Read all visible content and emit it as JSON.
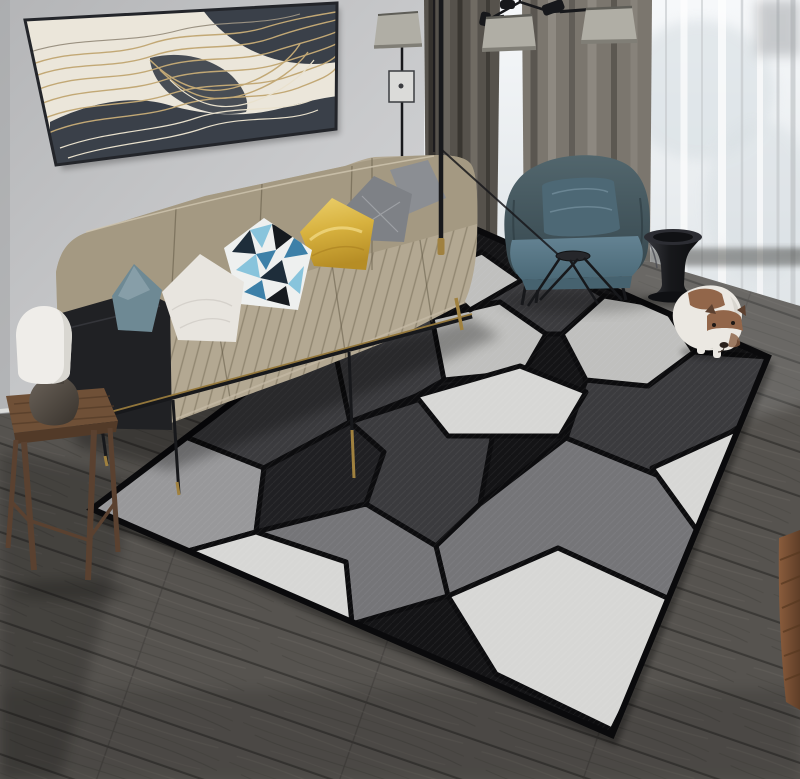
{
  "meta": {
    "type": "photograph",
    "description": "Modern living room with a beige fabric sofa, colorful pillows, abstract gold-line wall art, a teal armchair, black floor and ceiling lamps, sheer curtains over a bright snowy window, dark wood plank flooring, a black pedestal side table, a white-and-brown puppy, and a large gray 3D geometric polygon area rug.",
    "width": 800,
    "height": 779
  },
  "palette": {
    "wall": "#c9cacc",
    "wallDeep": "#b2b3b5",
    "baseboard": "#dcdddb",
    "artBg": "#ebe6da",
    "artDark": "#3a4049",
    "artGold": "#c2a875",
    "artFrame": "#23252a",
    "curtainDark": "#56524c",
    "curtainMid": "#7b766e",
    "curtainLight": "#918c84",
    "sheer": "#e9ebed",
    "window": "#f4f6f8",
    "snowShade": "#d5dde1",
    "sheerFold": "#ffffff",
    "sheerGray": "#c6cacd",
    "lampShade": "#b0aea5",
    "lampShadeDark": "#807e76",
    "metal": "#17181b",
    "brass": "#a0813f",
    "floor": "#56534f",
    "plankGap": "#3b3936",
    "grainDark": "#45423e",
    "grainLight": "#696560",
    "rugBase": "#141416",
    "rugGap": "#0c0c0e",
    "rugWhite": "#d7d7d5",
    "rugLight": "#c0c0be",
    "rugMidLight": "#98989a",
    "rugMid": "#757578",
    "rugDark": "#3b3b3e",
    "rugBlack": "#202023",
    "sofa": "#b3a892",
    "sofaDark": "#a1967f",
    "sofaBase": "#202124",
    "pTeal": "#6e8994",
    "pWhite": "#e8e5df",
    "pGold": "#d7b13e",
    "pGray1": "#7e8186",
    "pGray2": "#8b8e93",
    "geoLight": "#88c4dc",
    "geoBlue": "#3d80a8",
    "geoNavy": "#1e2d3a",
    "geoBlack": "#161a1e",
    "geoWhite": "#eef0ef",
    "chair": "#46585e",
    "chairSeat": "#587586",
    "chairPillow": "#4d6875",
    "stool": "#1c1d20",
    "wood": "#6f5037",
    "woodDark": "#523a28",
    "dogWhite": "#ebe8e2",
    "dogBrown": "#92664a",
    "dogDark": "#5d4130",
    "brown": "#7e5134",
    "tlShade": "#efede9",
    "tlBase": "#544d45"
  },
  "objects": {
    "artwork": {
      "label": "abstract wall art with gold wave lines on cream and charcoal"
    },
    "sofa": {
      "label": "beige channel-stitched fabric sofa with black base and brass-tipped metal legs"
    },
    "pillows": [
      {
        "label": "teal lumbar pillow"
      },
      {
        "label": "white throw pillow"
      },
      {
        "label": "blue geometric triangle print pillow"
      },
      {
        "label": "gold satin pillow"
      },
      {
        "label": "dark gray pillow"
      },
      {
        "label": "light gray pillow"
      }
    ],
    "armchair": {
      "label": "slate teal armchair with matching pillow"
    },
    "side_table": {
      "label": "rustic wooden stool side table"
    },
    "table_lamp": {
      "label": "white dome table lamp with dark round base"
    },
    "floor_lamp": {
      "label": "black floor lamp with gray shade"
    },
    "ceiling_lamp": {
      "label": "black multi-arm ceiling lamp with gray cone shades"
    },
    "curtains": {
      "label": "gray curtain panels with white sheer drapes"
    },
    "window": {
      "label": "bright window with snowy trees outside"
    },
    "rug": {
      "label": "gray 3D geometric area rug",
      "pattern": "irregular polygons with black gaps",
      "colors": [
        "white",
        "light gray",
        "mid gray",
        "charcoal",
        "black"
      ]
    },
    "pedestal_table": {
      "label": "black hourglass pedestal side table"
    },
    "coffee_table": {
      "label": "small black metal cross-leg table"
    },
    "dog": {
      "label": "white puppy with brown head patches standing on the rug"
    },
    "floor": {
      "label": "dark gray-brown wood plank floor laid diagonally"
    },
    "wood_piece": {
      "label": "brown wooden furniture edge at right border"
    }
  }
}
